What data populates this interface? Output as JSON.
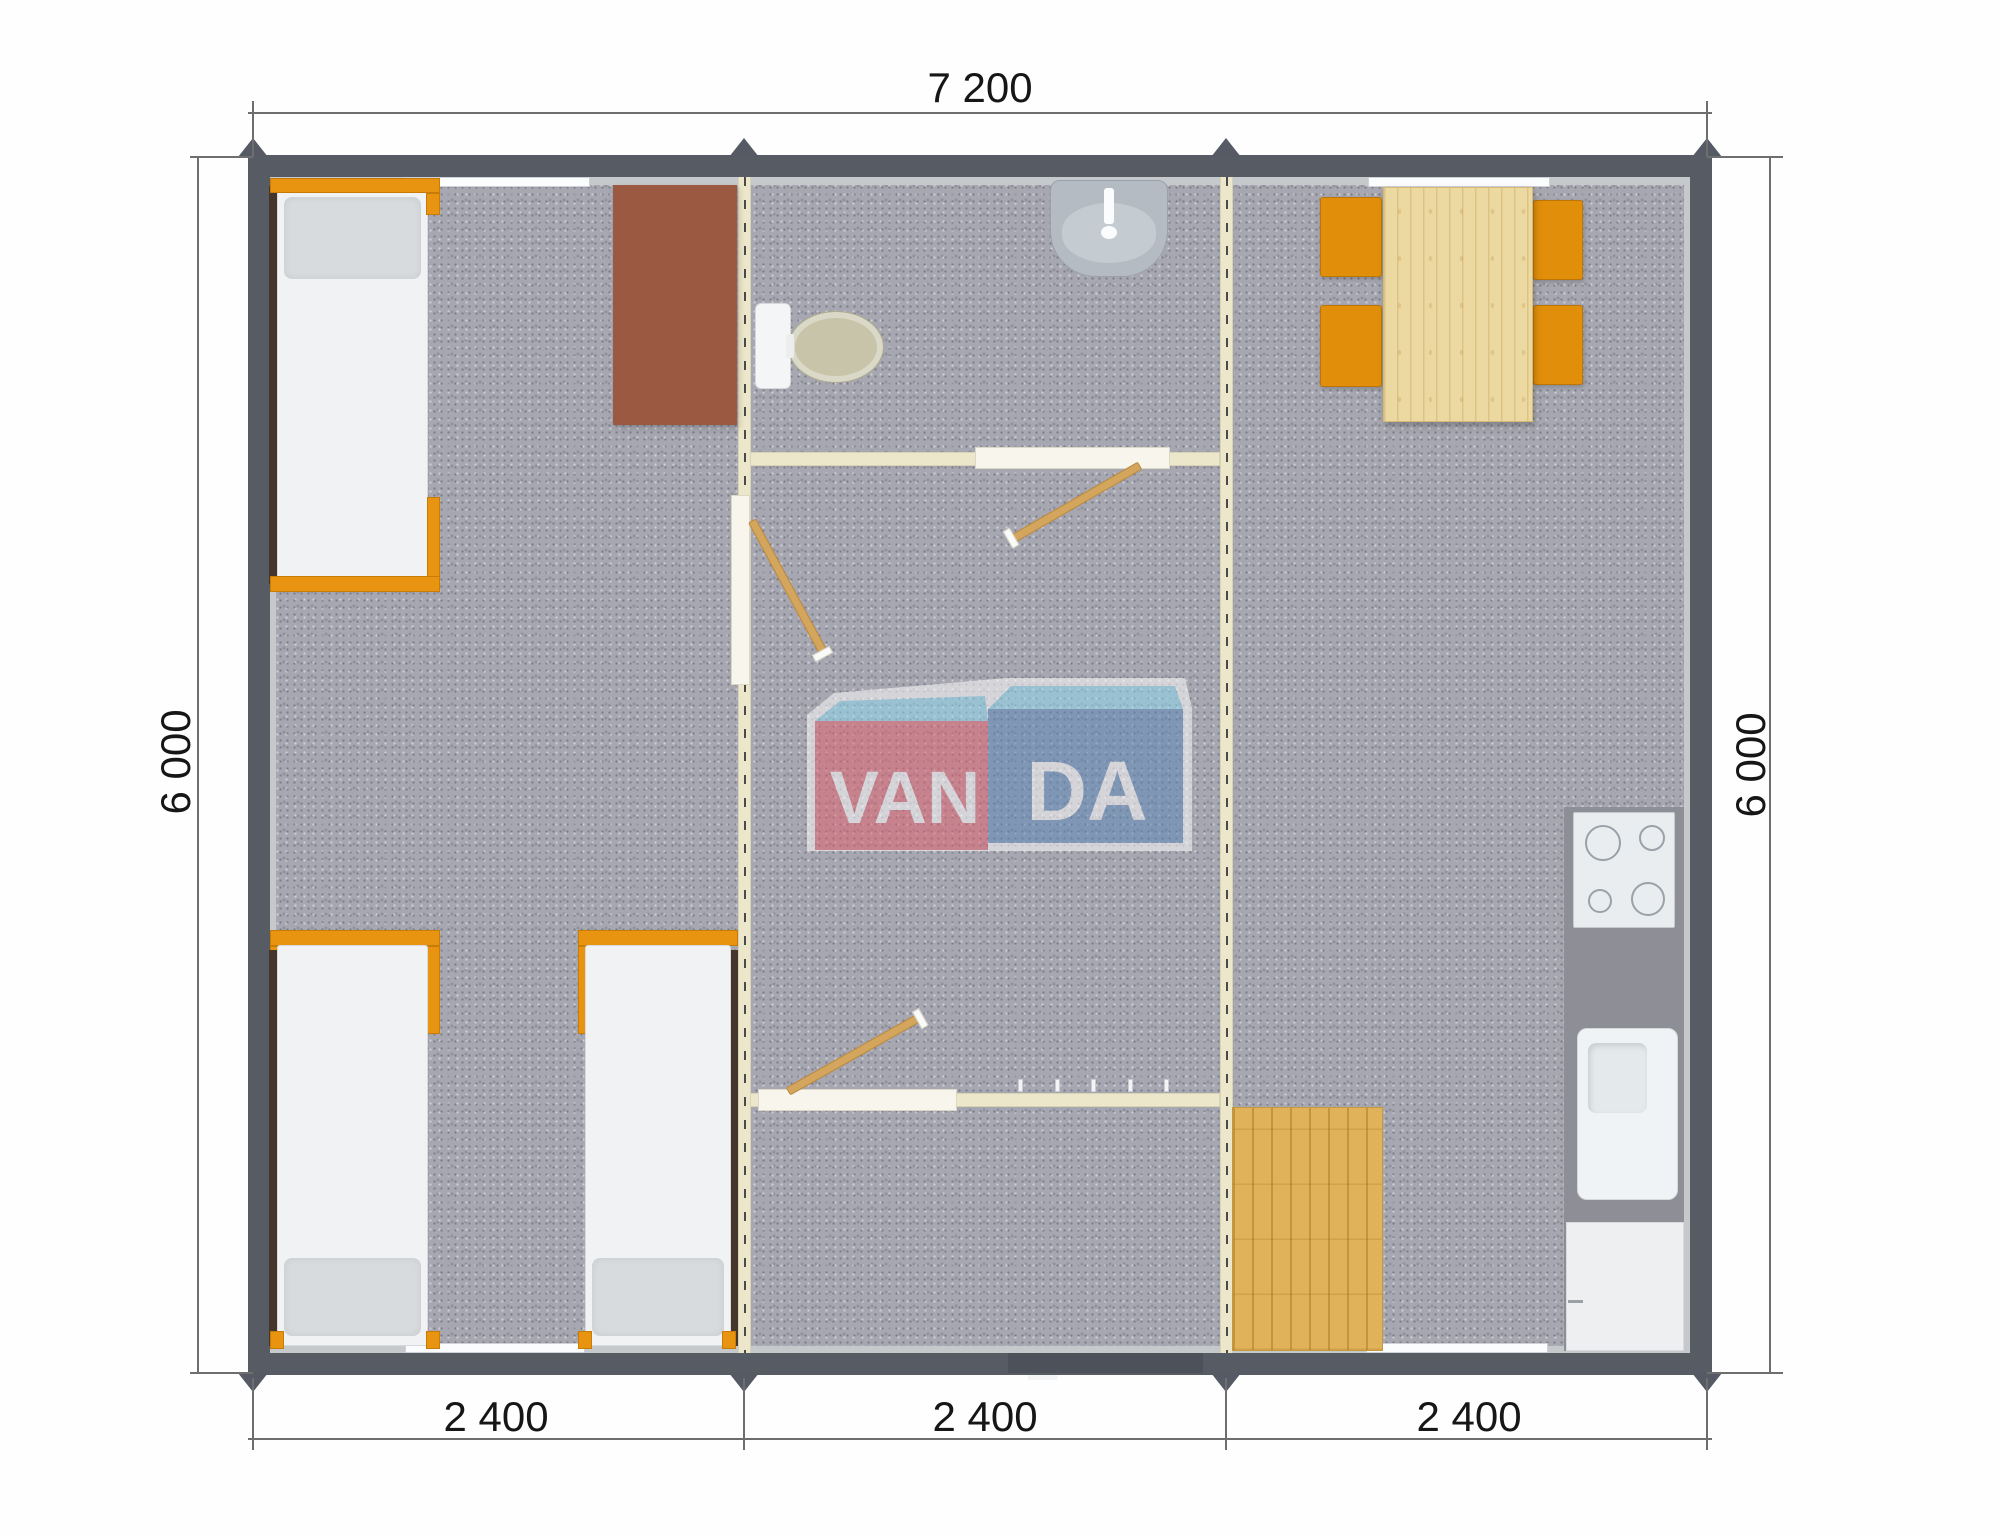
{
  "meta": {
    "type": "modular-building-floor-plan",
    "brand": "VANDA"
  },
  "dims": {
    "top": "7 200",
    "left": "6 000",
    "right": "6 000",
    "b1": "2 400",
    "b2": "2 400",
    "b3": "2 400"
  },
  "logo": {
    "van": "VAN",
    "da": "DA",
    "pink": "#e3616e",
    "blue": "#5b88b7",
    "top_blue": "#8fd9f0",
    "outline": "#ffffff"
  },
  "colors": {
    "exterior_wall": "#575b64",
    "carpet": "#a7a7b1",
    "module_seam": "#ece6ca",
    "furniture_orange": "#e89410",
    "wood_light": "#ecd9a1",
    "wood_mat": "#e0b259",
    "wardrobe_brown": "#9b5942",
    "kitchen_counter": "#8e8e96",
    "fixture_white": "#f1f3f5"
  },
  "elements": {
    "beds": 3,
    "dining_chairs": 4,
    "windows": 4,
    "door_leaves": 3,
    "fixtures": [
      "toilet",
      "bathroom-sink",
      "cooktop",
      "kitchen-sink",
      "kitchen-cabinet"
    ]
  }
}
